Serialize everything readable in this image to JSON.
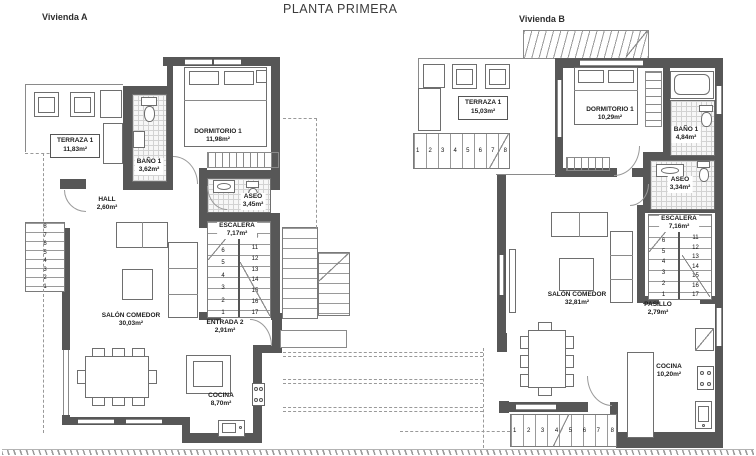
{
  "title": "PLANTA PRIMERA",
  "vivienda_a": {
    "label": "Vivienda A",
    "terraza": {
      "name": "TERRAZA 1",
      "area": "11,83m²"
    },
    "bano": {
      "name": "BAÑO 1",
      "area": "3,62m²"
    },
    "dormitorio": {
      "name": "DORMITORIO 1",
      "area": "11,98m²"
    },
    "hall": {
      "name": "HALL",
      "area": "2,60m²"
    },
    "aseo": {
      "name": "ASEO",
      "area": "3,45m²"
    },
    "escalera": {
      "name": "ESCALERA",
      "area": "7,17m²"
    },
    "salon": {
      "name": "SALÓN COMEDOR",
      "area": "30,03m²"
    },
    "entrada": {
      "name": "ENTRADA 2",
      "area": "2,91m²"
    },
    "cocina": {
      "name": "COCINA",
      "area": "8,70m²"
    },
    "stair_left_col": [
      "8",
      "7",
      "6",
      "5",
      "4",
      "3",
      "2",
      "1"
    ],
    "stair_right_col": [
      "9",
      "10",
      "11",
      "12",
      "13",
      "14",
      "15",
      "16",
      "17"
    ],
    "ext_stair_numbers": [
      "8",
      "7",
      "6",
      "5",
      "4",
      "3",
      "2",
      "1"
    ]
  },
  "vivienda_b": {
    "label": "Vivienda B",
    "terraza": {
      "name": "TERRAZA 1",
      "area": "15,03m²"
    },
    "dormitorio": {
      "name": "DORMITORIO 1",
      "area": "10,29m²"
    },
    "bano": {
      "name": "BAÑO 1",
      "area": "4,84m²"
    },
    "aseo": {
      "name": "ASEO",
      "area": "3,34m²"
    },
    "escalera": {
      "name": "ESCALERA",
      "area": "7,16m²"
    },
    "salon": {
      "name": "SALÓN COMEDOR",
      "area": "32,81m²"
    },
    "pasillo": {
      "name": "PASILLO",
      "area": "2,79m²"
    },
    "cocina": {
      "name": "COCINA",
      "area": "10,20m²"
    },
    "stair_left_col": [
      "8",
      "7",
      "6",
      "5",
      "4",
      "3",
      "2",
      "1"
    ],
    "stair_right_col": [
      "9",
      "10",
      "11",
      "12",
      "13",
      "14",
      "15",
      "16",
      "17"
    ],
    "ext_stair_top_numbers": [
      "1",
      "2",
      "3",
      "4",
      "5",
      "6",
      "7",
      "8"
    ],
    "ext_stair_bottom_numbers": [
      "1",
      "2",
      "3",
      "4",
      "5",
      "6",
      "7",
      "8"
    ]
  }
}
